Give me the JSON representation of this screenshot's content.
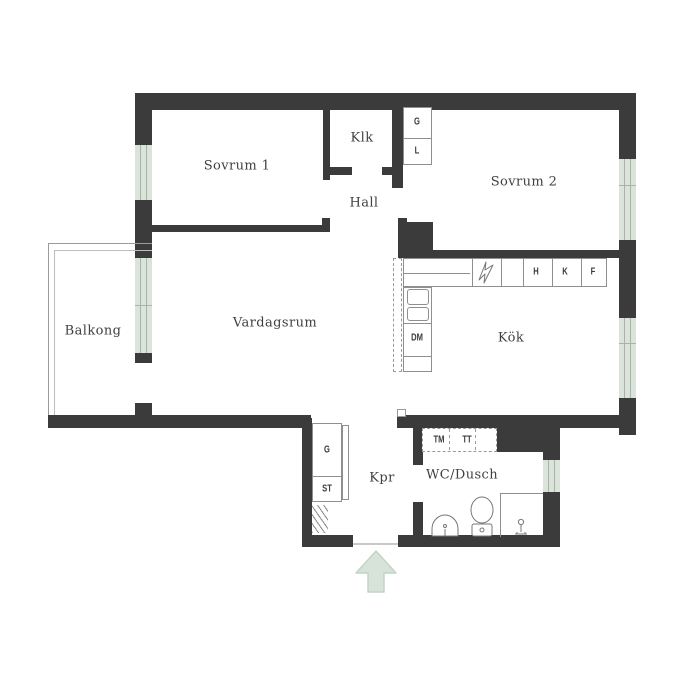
{
  "colors": {
    "wall": "#3b3b3b",
    "window": "#dbe4db",
    "window_line": "#a9b3a9",
    "arrow_fill": "#d7e3d8",
    "arrow_border": "#c2d4c4",
    "text": "#3f3f3f"
  },
  "rooms": {
    "sovrum1": "Sovrum 1",
    "klk": "Klk",
    "hall": "Hall",
    "sovrum2": "Sovrum 2",
    "balkong": "Balkong",
    "vardagsrum": "Vardagsrum",
    "kok": "Kök",
    "kpr": "Kpr",
    "wc_dusch": "WC/Dusch"
  },
  "fixtures": {
    "wardrobe_upper": "G",
    "linen_closet": "L",
    "shelf": "H",
    "fridge": "K",
    "freezer": "F",
    "dishwasher": "DM",
    "washing_machine": "TM",
    "dryer": "TT",
    "wardrobe_lower": "G",
    "cleaning_closet": "ST"
  }
}
